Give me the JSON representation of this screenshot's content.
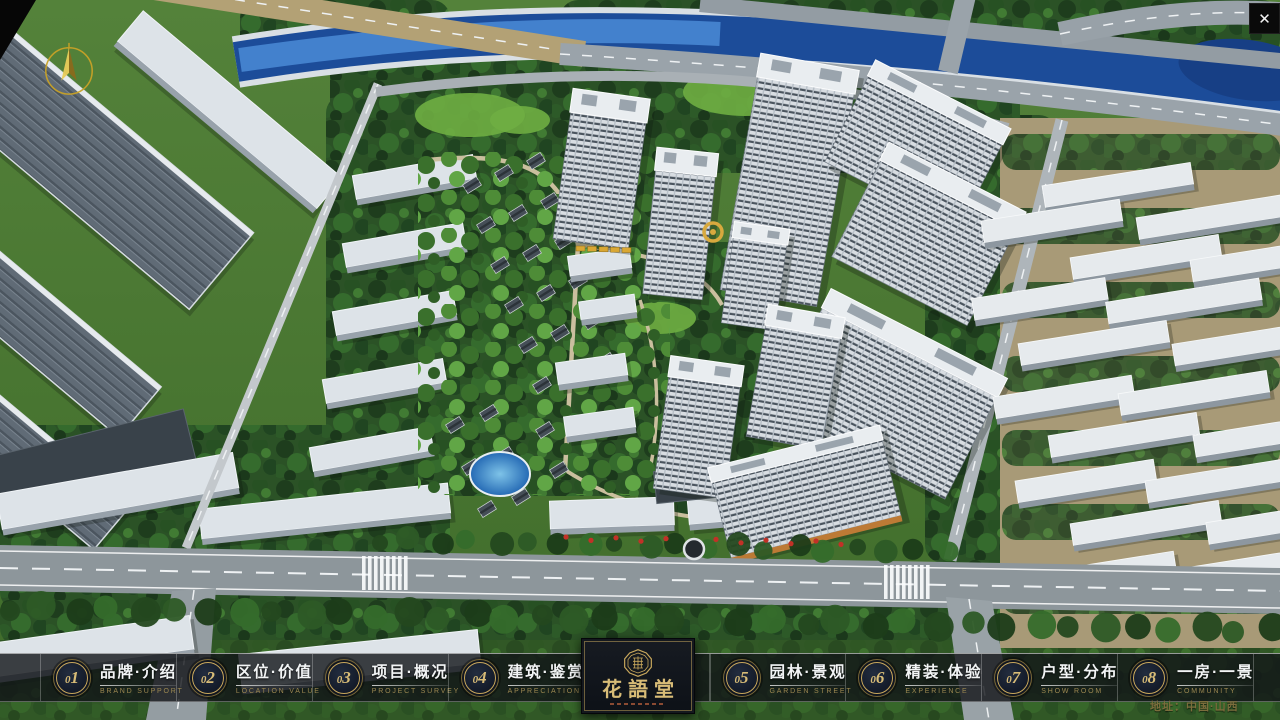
{
  "window": {
    "close_glyph": "✕"
  },
  "nav": {
    "items": [
      {
        "num": "01",
        "zh": "品牌·介绍",
        "en": "BRAND SUPPORT"
      },
      {
        "num": "02",
        "zh": "区位·价值",
        "en": "LOCATION VALUE"
      },
      {
        "num": "03",
        "zh": "项目·概况",
        "en": "PROJECT SURVEY"
      },
      {
        "num": "04",
        "zh": "建筑·鉴赏",
        "en": "APPRECIATION"
      },
      {
        "num": "05",
        "zh": "园林·景观",
        "en": "GARDEN STREET"
      },
      {
        "num": "06",
        "zh": "精装·体验",
        "en": "EXPERIENCE"
      },
      {
        "num": "07",
        "zh": "户型·分布",
        "en": "SHOW ROOM"
      },
      {
        "num": "08",
        "zh": "一房·一景",
        "en": "COMMUNITY"
      }
    ]
  },
  "logo": {
    "title": "花語堂"
  },
  "footer": {
    "address": "地址：中国·山西"
  },
  "palette": {
    "gold": "#c9a85c",
    "gold-bright": "#d8bc77",
    "bar-bg": "rgba(18,20,24,0.8)",
    "panel-bg": "#0d1117",
    "text-light": "#f2f4f5",
    "en-gold": "#9c8851",
    "address-gold": "#7b6d3c",
    "river-blue": "#1c4c99",
    "forest-green": "#2b5226",
    "road-gray": "#8d969b"
  }
}
